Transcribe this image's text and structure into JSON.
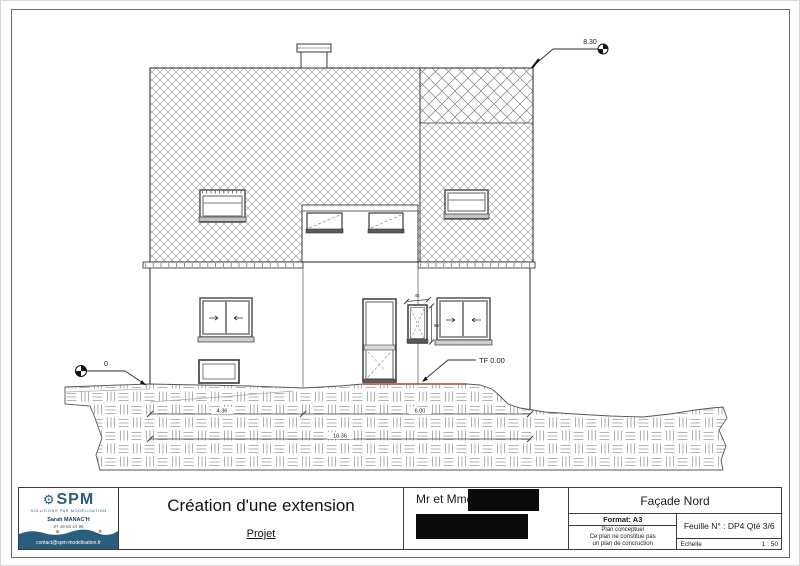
{
  "annotations": {
    "ridge_level": "8.30",
    "ground_level": "0",
    "tf_level": "TF 0.00",
    "dim_left": "4.36",
    "dim_right": "6.00",
    "dim_total": "10.36",
    "small_window_width": "45",
    "small_window_height": "95"
  },
  "title_block": {
    "company": {
      "name": "SPM",
      "gear_icon": "gear",
      "tagline": "solutions par modélisation",
      "contact_name": "Sarah MANAC'H",
      "phone": "07 49 63 24 88",
      "email": "contact@spm-modelisation.fr",
      "brand_color": "#2a5e7d",
      "accent_color": "#e0813f"
    },
    "project_title": "Création d'une extension",
    "project_label": "Projet",
    "client_label": "Mr et Mme",
    "view_title": "Façade Nord",
    "format_label": "Format: A3",
    "notes": [
      "Plan conceptuel",
      "Ce plan ne constitue pas",
      "un plan de concruction"
    ],
    "sheet_label": "Feuille N° : DP4 Qté 3/6",
    "scale_label": "Echelle",
    "scale_value": "1 : 50"
  }
}
